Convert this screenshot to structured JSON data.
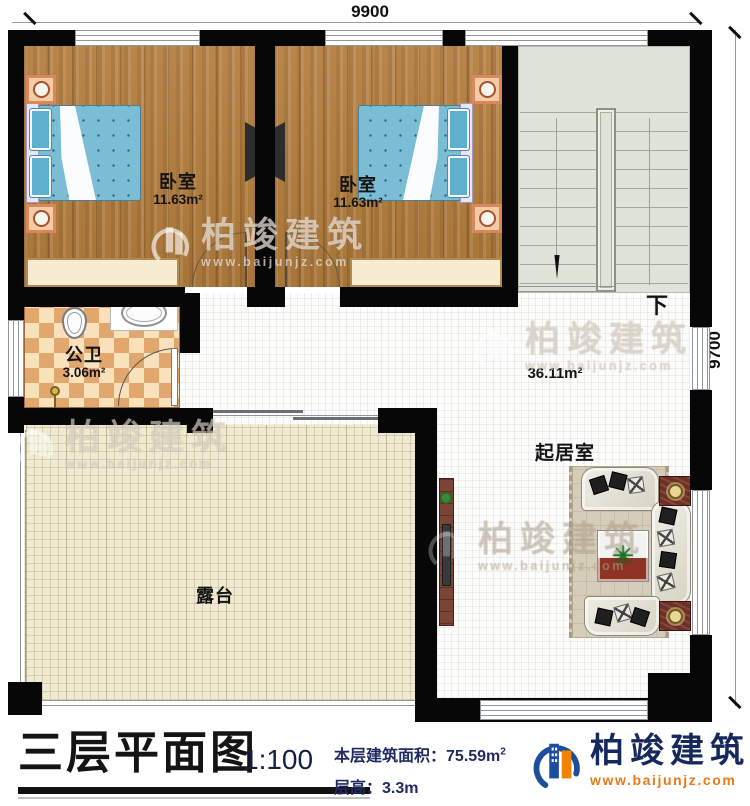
{
  "plan": {
    "dim_top": "9900",
    "dim_right": "9700",
    "stairs": {
      "down_label": "下"
    },
    "rooms": {
      "bedroom1": {
        "name": "卧室",
        "area": "11.63m²"
      },
      "bedroom2": {
        "name": "卧室",
        "area": "11.63m²"
      },
      "bathroom": {
        "name": "公卫",
        "area": "3.06m²"
      },
      "living": {
        "name": "起居室",
        "area": "36.11m²"
      },
      "terrace": {
        "name": "露台"
      }
    }
  },
  "watermark": {
    "brand": "柏竣建筑",
    "url": "www.baijunjz.com"
  },
  "footer": {
    "title": "三层平面图",
    "scale": "1:100",
    "area_label": "本层建筑面积：",
    "area_value": "75.59m",
    "area_sup": "2",
    "height_label": "层高：",
    "height_value": "3.3m",
    "brand": "柏竣建筑",
    "brand_url": "www.baijunjz.com"
  },
  "colors": {
    "wall": "#070707",
    "bed": "#7cbdd6",
    "stairs": "#e0e3d9",
    "terrace": "#efead1",
    "brand_navy": "#16285c",
    "brand_orange": "#e87a18"
  }
}
